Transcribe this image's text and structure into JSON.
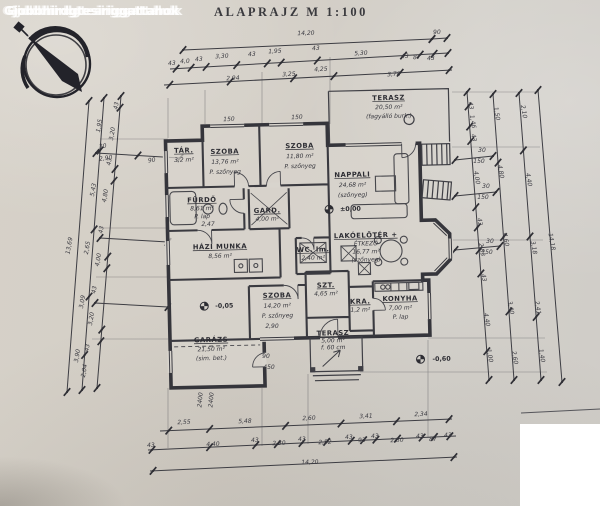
{
  "watermark": "Gjobbhirdgtesiriggattahok",
  "title": "ALAPRAJZ  M 1:100",
  "colors": {
    "ink": "#3a3a40",
    "paper": "#d4cfc7",
    "paper_light": "#d8d4cd",
    "white": "#ffffff"
  },
  "compass": {
    "icon": "north-arrow-compass"
  },
  "plan": {
    "rooms": [
      {
        "id": "tar",
        "x": 186,
        "y": 150,
        "dy": 9,
        "lines": [
          "TÁR.",
          "3,2 m²"
        ]
      },
      {
        "id": "szoba-1",
        "x": 227,
        "y": 152,
        "dy": 10,
        "lines": [
          "SZOBA",
          "13,76 m²",
          "P. szőnyeg"
        ]
      },
      {
        "id": "szoba-2",
        "x": 302,
        "y": 148,
        "dy": 10,
        "lines": [
          "SZOBA",
          "11,80 m²",
          "P. szőnyeg"
        ]
      },
      {
        "id": "nappali",
        "x": 354,
        "y": 178,
        "dy": 10,
        "lines": [
          "NAPPALI",
          "24,68 m²",
          "(szőnyeg)"
        ]
      },
      {
        "id": "terasz-felso",
        "x": 392,
        "y": 102,
        "dy": 9,
        "lines": [
          "TERASZ",
          "20,50 m²",
          "(fagyálló burk.)"
        ]
      },
      {
        "id": "furdo",
        "x": 203,
        "y": 200,
        "dy": 8,
        "lines": [
          "FÜRDŐ",
          "8,61 m²",
          "P. lap"
        ]
      },
      {
        "id": "hazi-munka",
        "x": 220,
        "y": 247,
        "dy": 9,
        "lines": [
          "HÁZI MUNKA",
          "8,56 m²"
        ]
      },
      {
        "id": "gard",
        "x": 268,
        "y": 212,
        "dy": 8,
        "lines": [
          "GARD.",
          "4,00 m²"
        ]
      },
      {
        "id": "wc",
        "x": 313,
        "y": 252,
        "dy": 8,
        "lines": [
          "WC. lm.",
          "2,40 m²"
        ]
      },
      {
        "id": "lakoeloter-etkezo",
        "x": 366,
        "y": 239,
        "dy": 8,
        "lines": [
          "LAKÓELŐTÉR +",
          "ÉTKEZŐ",
          "16,77 m²",
          "(szőnyeg)"
        ]
      },
      {
        "id": "szt",
        "x": 325,
        "y": 288,
        "dy": 8,
        "lines": [
          "SZT.",
          "4,65 m²"
        ]
      },
      {
        "id": "szoba-3",
        "x": 276,
        "y": 297,
        "dy": 10,
        "lines": [
          "SZOBA",
          "14,20 m²",
          "P. szőnyeg"
        ]
      },
      {
        "id": "kamra",
        "x": 359,
        "y": 305,
        "dy": 8,
        "lines": [
          "KRA.",
          "1,2 m²"
        ]
      },
      {
        "id": "konyha",
        "x": 399,
        "y": 303,
        "dy": 9,
        "lines": [
          "KONYHA",
          "7,00 m²",
          "P. lap"
        ]
      },
      {
        "id": "garazs",
        "x": 209,
        "y": 340,
        "dy": 9,
        "lines": [
          "GARÁZS",
          "21,50 m²",
          "(sim. bet.)"
        ]
      },
      {
        "id": "terasz-also",
        "x": 331,
        "y": 336,
        "dy": 7,
        "lines": [
          "TERASZ",
          "5,00 m²",
          "f. 60 cm"
        ]
      }
    ],
    "levels": [
      {
        "t": "±0,00",
        "x": 341,
        "y": 212,
        "sx": 330,
        "sy": 210
      },
      {
        "t": "-0,05",
        "x": 214,
        "y": 306,
        "sx": 203,
        "sy": 304
      },
      {
        "t": "-0,60",
        "x": 430,
        "y": 364,
        "sx": 418,
        "sy": 362
      }
    ],
    "dims": [
      [
        "14,20",
        306,
        35,
        -2
      ],
      [
        "90",
        437,
        34,
        -2
      ],
      [
        "43",
        172,
        65,
        -3
      ],
      [
        "4,0",
        185,
        63,
        -3
      ],
      [
        "43",
        199,
        61,
        -3
      ],
      [
        "3,30",
        222,
        58,
        -3
      ],
      [
        "43",
        252,
        56,
        -3
      ],
      [
        "1,95",
        275,
        53,
        -3
      ],
      [
        "43",
        316,
        50,
        -3
      ],
      [
        "5,30",
        361,
        55,
        -3
      ],
      [
        "43",
        405,
        58,
        -3
      ],
      [
        "87",
        417,
        59,
        -3
      ],
      [
        "43",
        431,
        60,
        -3
      ],
      [
        "2,94",
        233,
        80,
        -3
      ],
      [
        "3,25",
        289,
        76,
        -3
      ],
      [
        "4,25",
        321,
        71,
        -3
      ],
      [
        "3,78",
        394,
        76,
        -3
      ],
      [
        "2,55",
        184,
        424,
        -2
      ],
      [
        "5,48",
        245,
        423,
        -2
      ],
      [
        "2,60",
        309,
        420,
        -2
      ],
      [
        "3,41",
        366,
        418,
        -2
      ],
      [
        "2,34",
        421,
        416,
        -2
      ],
      [
        "43",
        151,
        447,
        -2
      ],
      [
        "4,40",
        213,
        446,
        -2
      ],
      [
        "43",
        255,
        442,
        -2
      ],
      [
        "2,30",
        279,
        445,
        -2
      ],
      [
        "43",
        302,
        441,
        -2
      ],
      [
        "2,52",
        325,
        444,
        -2
      ],
      [
        "43",
        349,
        439,
        -2
      ],
      [
        "93",
        362,
        442,
        -2
      ],
      [
        "43",
        375,
        438,
        -2
      ],
      [
        "2,50",
        397,
        442,
        -2
      ],
      [
        "43",
        420,
        438,
        -2
      ],
      [
        "87",
        433,
        441,
        -2
      ],
      [
        "43",
        448,
        437,
        -2
      ],
      [
        "14,20",
        310,
        464,
        -2
      ],
      [
        "43",
        118,
        106,
        -80
      ],
      [
        "3,20",
        114,
        134,
        -80
      ],
      [
        "43",
        111,
        162,
        -80
      ],
      [
        "4,80",
        107,
        196,
        -80
      ],
      [
        "43",
        103,
        230,
        -80
      ],
      [
        "4,00",
        100,
        260,
        -80
      ],
      [
        "43",
        96,
        290,
        -80
      ],
      [
        "3,20",
        93,
        319,
        -80
      ],
      [
        "43",
        89,
        348,
        -80
      ],
      [
        "2,04",
        86,
        371,
        -80
      ],
      [
        "1,95",
        101,
        126,
        -80
      ],
      [
        "5,43",
        95,
        190,
        -80
      ],
      [
        "2,65",
        89,
        248,
        -80
      ],
      [
        "3,09",
        84,
        302,
        -80
      ],
      [
        "3,90",
        79,
        356,
        -80
      ],
      [
        "13,69",
        71,
        246,
        -80
      ],
      [
        "30",
        103,
        148,
        -8
      ],
      [
        "2,90",
        106,
        160,
        -8
      ],
      [
        "90",
        152,
        162,
        -8
      ],
      [
        "43",
        469,
        106,
        80
      ],
      [
        "1,46",
        471,
        122,
        80
      ],
      [
        "43",
        472,
        138,
        80
      ],
      [
        "4,00",
        475,
        178,
        80
      ],
      [
        "43",
        478,
        222,
        80
      ],
      [
        "2,83",
        480,
        250,
        80
      ],
      [
        "43",
        482,
        278,
        80
      ],
      [
        "4,40",
        485,
        320,
        80
      ],
      [
        "1,00",
        488,
        356,
        80
      ],
      [
        "1,50",
        495,
        114,
        80
      ],
      [
        "4,80",
        499,
        172,
        80
      ],
      [
        "4,60",
        504,
        240,
        80
      ],
      [
        "3,40",
        509,
        308,
        80
      ],
      [
        "2,60",
        513,
        358,
        80
      ],
      [
        "2,10",
        522,
        112,
        80
      ],
      [
        "4,40",
        527,
        180,
        80
      ],
      [
        "3,18",
        532,
        248,
        80
      ],
      [
        "2,41",
        536,
        308,
        80
      ],
      [
        "1,40",
        540,
        356,
        80
      ],
      [
        "14,18",
        550,
        242,
        80
      ],
      [
        "30",
        482,
        152,
        0
      ],
      [
        "150",
        479,
        163,
        0
      ],
      [
        "30",
        486,
        188,
        0
      ],
      [
        "150",
        483,
        199,
        0
      ],
      [
        "30",
        490,
        243,
        0
      ],
      [
        "150",
        487,
        254,
        0
      ],
      [
        "150",
        229,
        121,
        -2
      ],
      [
        "150",
        297,
        119,
        -2
      ],
      [
        "2,47",
        208,
        226,
        0
      ],
      [
        "2,90",
        272,
        328,
        0
      ],
      [
        "90",
        266,
        358,
        0
      ],
      [
        "450",
        269,
        369,
        0
      ],
      [
        "2400",
        202,
        400,
        -85
      ],
      [
        "2400",
        213,
        400,
        -85
      ]
    ]
  }
}
